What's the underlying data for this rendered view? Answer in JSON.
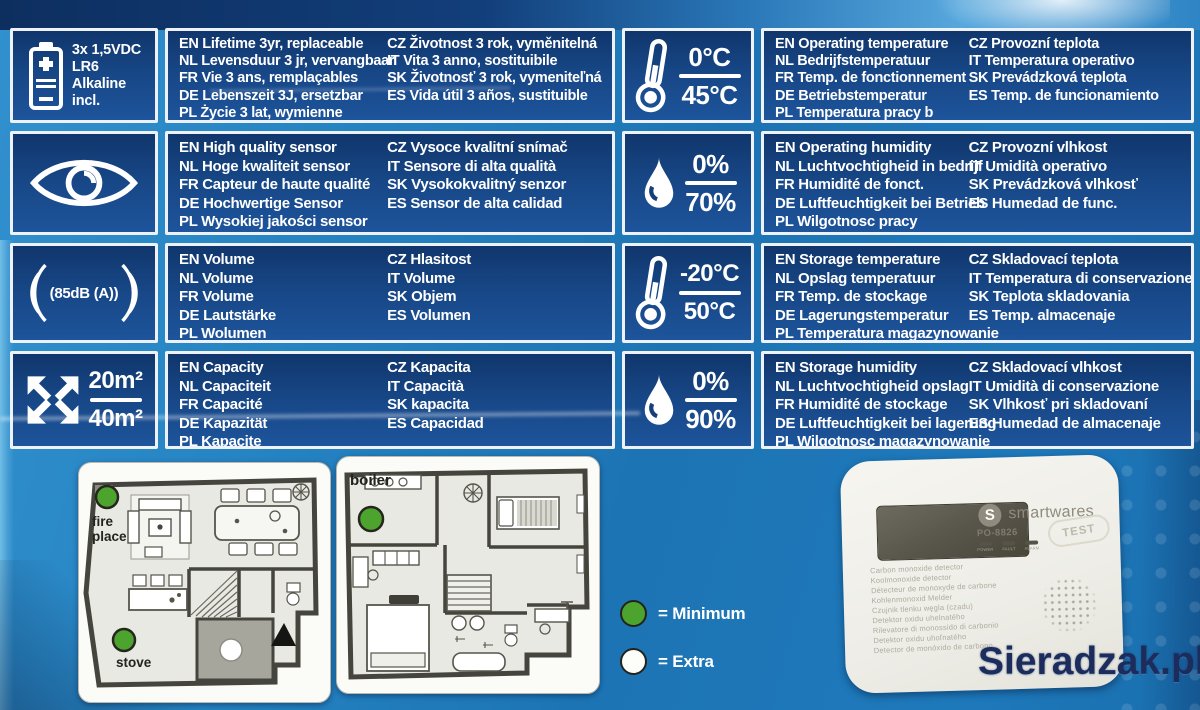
{
  "colors": {
    "table_cell": "#16417d",
    "accent_green": "#4ca42f",
    "watermark_navy": "#1c2c5c",
    "box_blue": "#1d74b4"
  },
  "table": {
    "rows": [
      {
        "battery_caption": [
          "3x 1,5VDC",
          "LR6",
          "Alkaline",
          "incl."
        ],
        "left_a": [
          "EN Lifetime 3yr, replaceable",
          "NL Levensduur 3 jr, vervangbaar",
          "FR Vie 3 ans, remplaçables",
          "DE Lebenszeit 3J, ersetzbar",
          "PL Życie 3 lat, wymienne"
        ],
        "left_b": [
          "CZ Životnost 3 rok, vyměnitelná",
          "IT Vita 3 anno, sostituibile",
          "SK Životnosť 3 rok, vymeniteľná",
          "ES Vida útil 3 años, sustituible"
        ],
        "temp_top": "0°C",
        "temp_bottom": "45°C",
        "right_a": [
          "EN Operating temperature",
          "NL Bedrijfstemperatuur",
          "FR Temp. de fonctionnement",
          "DE Betriebstemperatur",
          "PL Temperatura pracy b"
        ],
        "right_b": [
          "CZ Provozní teplota",
          "IT Temperatura operativo",
          "SK Prevádzková teplota",
          "ES Temp. de funcionamiento"
        ]
      },
      {
        "left_a": [
          "EN High quality sensor",
          "NL Hoge kwaliteit sensor",
          "FR Capteur de haute qualité",
          "DE Hochwertige Sensor",
          "PL Wysokiej jakości sensor"
        ],
        "left_b": [
          "CZ Vysoce kvalitní snímač",
          "IT Sensore di alta qualità",
          "SK Vysokokvalitný senzor",
          "ES Sensor de alta calidad"
        ],
        "hum_top": "0%",
        "hum_bottom": "70%",
        "right_a": [
          "EN Operating humidity",
          "NL Luchtvochtigheid in bedrijf",
          "FR Humidité de fonct.",
          "DE Luftfeuchtigkeit bei Betrieb",
          "PL Wilgotnosc pracy"
        ],
        "right_b": [
          "CZ Provozní vlhkost",
          "IT Umidità operativo",
          "SK Prevádzková vlhkosť",
          "ES Humedad de func."
        ]
      },
      {
        "sound_label": "(85dB (A))",
        "left_a": [
          "EN Volume",
          "NL Volume",
          "FR Volume",
          "DE Lautstärke",
          "PL Wolumen"
        ],
        "left_b": [
          "CZ Hlasitost",
          "IT Volume",
          "SK Objem",
          "ES Volumen"
        ],
        "temp_top": "-20°C",
        "temp_bottom": "50°C",
        "right_a": [
          "EN Storage temperature",
          "NL Opslag temperatuur",
          "FR Temp. de stockage",
          "DE Lagerungstemperatur",
          "PL Temperatura magazynowanie"
        ],
        "right_b": [
          "CZ Skladovací teplota",
          "IT Temperatura di conservazione",
          "SK Teplota skladovania",
          "ES Temp. almacenaje"
        ]
      },
      {
        "area_top": "20m²",
        "area_bottom": "40m²",
        "left_a": [
          "EN Capacity",
          "NL Capaciteit",
          "FR Capacité",
          "DE Kapazität",
          "PL Kapacite"
        ],
        "left_b": [
          "CZ Kapacita",
          "IT Capacità",
          "SK kapacita",
          "ES Capacidad"
        ],
        "hum_top": "0%",
        "hum_bottom": "90%",
        "right_a": [
          "EN Storage humidity",
          "NL Luchtvochtigheid opslag",
          "FR Humidité de stockage",
          "DE Luftfeuchtigkeit bei lagerung",
          "PL Wilgotnosc magazynowanie"
        ],
        "right_b": [
          "CZ Skladovací vlhkost",
          "IT Umidità di conservazione",
          "SK Vlhkosť pri skladovaní",
          "ES Humedad de almacenaje"
        ]
      }
    ]
  },
  "floorplans": {
    "plan1": {
      "fireplace_label": "fire place",
      "stove_label": "stove"
    },
    "plan2": {
      "boiler_label": "boiler"
    }
  },
  "legend": {
    "minimum": "= Minimum",
    "extra": "= Extra"
  },
  "product": {
    "brand": "smartwares",
    "model": "PO-8826",
    "test_button": "TEST",
    "led_labels": [
      "POWER",
      "FAULT",
      "ALARM"
    ],
    "description_lines": [
      "Carbon monoxide detector",
      "Koolmonoxide detector",
      "Détecteur de monoxyde de carbone",
      "Kohlenmonoxid Melder",
      "Czujnik tlenku węgla (czadu)",
      "Detektor oxidu uhelnatého",
      "Rilevatore di monossido di carbonio",
      "Detektor oxidu uhoľnatého",
      "Detector de monóxido de carbono"
    ]
  },
  "watermark": "Sieradzak.pl"
}
